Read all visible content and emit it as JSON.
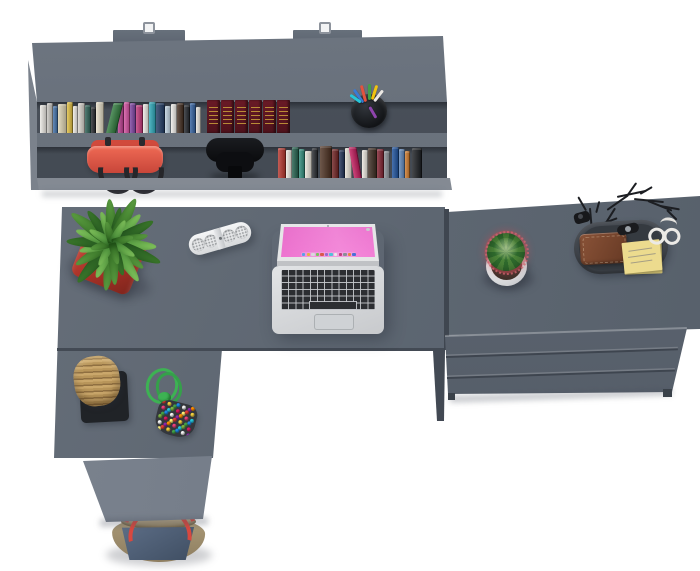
{
  "scene": {
    "description": "Top-down 3D render of a graphite-gray office furniture set: wall shelf with books, L-shaped desk with laptop and accessories, three-drawer chest",
    "background": "#ffffff",
    "furniture": {
      "surface": "#5f6873",
      "surface_light": "#7b828c",
      "recess_dark": "#454c55",
      "edge_dark": "#3f4650"
    }
  },
  "shelf": {
    "mount_hooks": 2,
    "books_row1": [
      {
        "w": 7,
        "h": 28,
        "c": "#eae8e3"
      },
      {
        "w": 6,
        "h": 30,
        "c": "#c7c5c0"
      },
      {
        "w": 5,
        "h": 27,
        "c": "#3f6fa8"
      },
      {
        "w": 9,
        "h": 29,
        "c": "#ddd3b2"
      },
      {
        "w": 6,
        "h": 31,
        "c": "#e0be3e"
      },
      {
        "w": 5,
        "h": 27,
        "c": "#efece6"
      },
      {
        "w": 7,
        "h": 30,
        "c": "#d8d4cc"
      },
      {
        "w": 6,
        "h": 28,
        "c": "#2a5d52"
      },
      {
        "w": 5,
        "h": 26,
        "c": "#24272b"
      },
      {
        "w": 8,
        "h": 31,
        "c": "#e7dfc8"
      },
      {
        "w": 10,
        "h": 30,
        "c": "#2f7a3c",
        "lean": -14,
        "ml": 2
      },
      {
        "w": 6,
        "h": 29,
        "c": "#b93a8d",
        "ml": 2
      },
      {
        "w": 6,
        "h": 31,
        "c": "#d44fa0"
      },
      {
        "w": 6,
        "h": 30,
        "c": "#7a3f9e"
      },
      {
        "w": 7,
        "h": 28,
        "c": "#c23579"
      },
      {
        "w": 6,
        "h": 29,
        "c": "#eceae5"
      },
      {
        "w": 7,
        "h": 31,
        "c": "#2aa7b8"
      },
      {
        "w": 9,
        "h": 30,
        "c": "#1f3a63"
      },
      {
        "w": 6,
        "h": 27,
        "c": "#bcd0de"
      },
      {
        "w": 6,
        "h": 29,
        "c": "#efede9"
      },
      {
        "w": 7,
        "h": 30,
        "c": "#402a1d"
      },
      {
        "w": 6,
        "h": 28,
        "c": "#20242a"
      },
      {
        "w": 6,
        "h": 30,
        "c": "#2f5e9e"
      },
      {
        "w": 5,
        "h": 26,
        "c": "#e8e4dc"
      }
    ],
    "encyclopedia": {
      "volumes": 6,
      "spine": "#5e1722",
      "gold": "#c9a03a"
    },
    "pen_cup": {
      "body": "#17191c",
      "pens": [
        "#3a7bd5",
        "#e2533f",
        "#43a047",
        "#f1c40f",
        "#ece9e4",
        "#26c6da",
        "#8e44ad"
      ]
    },
    "handbag": {
      "body": "#e2574c",
      "body_dark": "#c23f35",
      "handles": "#26262a"
    },
    "office_chair": {
      "color": "#0b0c0e"
    },
    "books_row2": [
      {
        "w": 8,
        "h": 30,
        "c": "#b5332a"
      },
      {
        "w": 6,
        "h": 28,
        "c": "#efe9e0"
      },
      {
        "w": 7,
        "h": 31,
        "c": "#1e5c49"
      },
      {
        "w": 6,
        "h": 29,
        "c": "#2e8b7a"
      },
      {
        "w": 7,
        "h": 27,
        "c": "#e8e4da"
      },
      {
        "w": 6,
        "h": 30,
        "c": "#23262b"
      },
      {
        "w": 12,
        "h": 32,
        "c": "#4a2e1e",
        "ml": 2
      },
      {
        "w": 7,
        "h": 29,
        "c": "#6e1f1f"
      },
      {
        "w": 6,
        "h": 28,
        "c": "#1d2f55"
      },
      {
        "w": 7,
        "h": 30,
        "c": "#e6e1d6"
      },
      {
        "w": 8,
        "h": 31,
        "c": "#c2185b",
        "lean": 10,
        "ml": 2
      },
      {
        "w": 6,
        "h": 28,
        "c": "#ece8df"
      },
      {
        "w": 9,
        "h": 30,
        "c": "#3b2b20"
      },
      {
        "w": 7,
        "h": 29,
        "c": "#801f2e"
      },
      {
        "w": 6,
        "h": 27,
        "c": "#8b8f96"
      },
      {
        "w": 7,
        "h": 31,
        "c": "#1a4f9c",
        "ml": 2
      },
      {
        "w": 6,
        "h": 29,
        "c": "#5c84b8"
      },
      {
        "w": 5,
        "h": 27,
        "c": "#d07a2a"
      },
      {
        "w": 10,
        "h": 30,
        "c": "#191c20",
        "ml": 2
      }
    ]
  },
  "desk": {
    "shape": "L-shaped",
    "surface": "#5d6671",
    "return_front": "#727a85",
    "plant": {
      "pot": "#b8423a",
      "leaf_palettes": [
        [
          "#1f4f1d",
          "#3c7a2c"
        ],
        [
          "#2c661f",
          "#5ea143"
        ],
        [
          "#3f8533",
          "#85c95f"
        ]
      ],
      "leaves": [
        {
          "a": -172,
          "l": 48,
          "w": 11,
          "t": 1
        },
        {
          "a": -156,
          "l": 38,
          "w": 10,
          "t": 2
        },
        {
          "a": -139,
          "l": 52,
          "w": 12,
          "t": 0
        },
        {
          "a": -121,
          "l": 42,
          "w": 10,
          "t": 1
        },
        {
          "a": -104,
          "l": 34,
          "w": 9,
          "t": 2
        },
        {
          "a": -88,
          "l": 46,
          "w": 11,
          "t": 0
        },
        {
          "a": -71,
          "l": 38,
          "w": 10,
          "t": 2
        },
        {
          "a": -54,
          "l": 50,
          "w": 12,
          "t": 1
        },
        {
          "a": -37,
          "l": 40,
          "w": 10,
          "t": 0
        },
        {
          "a": -20,
          "l": 33,
          "w": 9,
          "t": 2
        },
        {
          "a": -4,
          "l": 44,
          "w": 11,
          "t": 1
        },
        {
          "a": 12,
          "l": 36,
          "w": 9,
          "t": 0
        },
        {
          "a": 28,
          "l": 50,
          "w": 12,
          "t": 1
        },
        {
          "a": 45,
          "l": 40,
          "w": 10,
          "t": 2
        },
        {
          "a": 62,
          "l": 46,
          "w": 11,
          "t": 0
        },
        {
          "a": 78,
          "l": 36,
          "w": 9,
          "t": 1
        },
        {
          "a": 95,
          "l": 44,
          "w": 11,
          "t": 2
        },
        {
          "a": 112,
          "l": 52,
          "w": 12,
          "t": 0
        },
        {
          "a": 129,
          "l": 40,
          "w": 10,
          "t": 1
        },
        {
          "a": 146,
          "l": 46,
          "w": 11,
          "t": 2
        },
        {
          "a": 162,
          "l": 34,
          "w": 9,
          "t": 0
        },
        {
          "a": 176,
          "l": 42,
          "w": 10,
          "t": 1
        },
        {
          "a": -150,
          "l": 26,
          "w": 8,
          "t": 2
        },
        {
          "a": -105,
          "l": 22,
          "w": 8,
          "t": 1
        },
        {
          "a": -60,
          "l": 26,
          "w": 8,
          "t": 2
        },
        {
          "a": -15,
          "l": 22,
          "w": 8,
          "t": 1
        },
        {
          "a": 30,
          "l": 26,
          "w": 8,
          "t": 2
        },
        {
          "a": 75,
          "l": 22,
          "w": 8,
          "t": 1
        },
        {
          "a": 120,
          "l": 26,
          "w": 8,
          "t": 2
        },
        {
          "a": 165,
          "l": 22,
          "w": 8,
          "t": 1
        }
      ]
    },
    "speaker": {
      "body": "#eceeef",
      "grille": "#b9bcc0"
    },
    "laptop": {
      "body": "#d7d9db",
      "keys": "#2b2d31",
      "wallpaper": [
        "#ffffff",
        "#ffc6ee",
        "#f272d2",
        "#c23ba2",
        "#7b2172",
        "#38104a"
      ],
      "dock_icons": [
        "#5aa0e8",
        "#e8b13f",
        "#d8d8dc",
        "#7bc15c",
        "#d95a4a",
        "#9a6bd0",
        "#4fc3d8",
        "#e8e8ea",
        "#c23f7a",
        "#8a8f96",
        "#e8863f",
        "#4a6fd8"
      ]
    },
    "basket": {
      "weave": "#b8955a",
      "mat": "#202327"
    },
    "bead_pouch": {
      "cord": "#3db253",
      "pouch": "#34373c",
      "bead_count": 42,
      "bead_colors": [
        "#e03f35",
        "#f4d03f",
        "#43a047",
        "#1e88e5",
        "#f5f5f5",
        "#8e24aa",
        "#fb8c00",
        "#ec407a",
        "#26c6da",
        "#7cb342",
        "#d81b60",
        "#fff176"
      ]
    }
  },
  "chest": {
    "drawers": 3,
    "surface": "#5f6873",
    "front": "#5a626d",
    "cactus": {
      "pot": "#e8e9ea",
      "body": "#3c7a32",
      "spines": "#c05a64"
    },
    "valet_tray": {
      "tray": "#41464d",
      "wallet": "#7c4a30",
      "sticky_note": "#ecdb8e",
      "glasses": "#eceae6",
      "watch": "#1a1b1e",
      "branches": [
        {
          "x": 597,
          "y": 236,
          "l": 34,
          "a": -58
        },
        {
          "x": 607,
          "y": 209,
          "l": 26,
          "a": -35
        },
        {
          "x": 617,
          "y": 196,
          "l": 30,
          "a": -12
        },
        {
          "x": 627,
          "y": 195,
          "l": 16,
          "a": -55
        },
        {
          "x": 634,
          "y": 198,
          "l": 30,
          "a": 6
        },
        {
          "x": 648,
          "y": 200,
          "l": 26,
          "a": 22
        },
        {
          "x": 640,
          "y": 193,
          "l": 14,
          "a": -30
        },
        {
          "x": 592,
          "y": 233,
          "l": 26,
          "a": -95
        },
        {
          "x": 586,
          "y": 210,
          "l": 16,
          "a": -120
        },
        {
          "x": 596,
          "y": 212,
          "l": 12,
          "a": -75
        },
        {
          "x": 660,
          "y": 205,
          "l": 20,
          "a": 10
        },
        {
          "x": 667,
          "y": 209,
          "l": 14,
          "a": 45
        },
        {
          "x": 604,
          "y": 222,
          "l": 14,
          "a": -20
        },
        {
          "x": 612,
          "y": 231,
          "l": 40,
          "a": -8
        }
      ]
    }
  },
  "tote_bag": {
    "denim": "#4a5c74",
    "trim": "#9c8c74",
    "straps": "#d8483f"
  }
}
